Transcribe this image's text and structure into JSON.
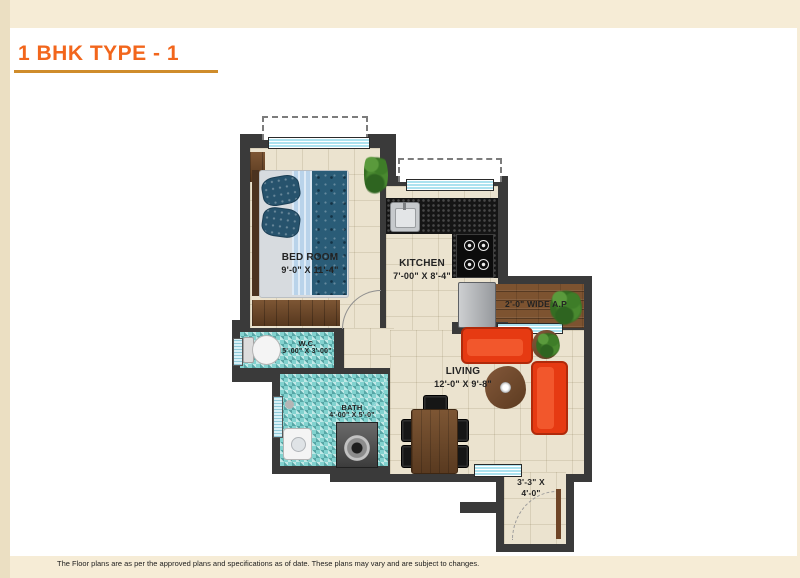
{
  "title": "1 BHK TYPE - 1",
  "disclaimer": "The Floor plans are as per the approved plans and specifications as of date. These plans may vary and are subject to changes.",
  "plan": {
    "bedroom": {
      "name": "BED ROOM",
      "dims": "9'-0\" X 11'-4\""
    },
    "kitchen": {
      "name": "KITCHEN",
      "dims": "7'-00\" X 8'-4\""
    },
    "wc": {
      "name": "W.C.",
      "dims": "5'-00\" X 3'-00\""
    },
    "bath": {
      "name": "BATH",
      "dims": "4'-00\" X 5'-0\""
    },
    "living": {
      "name": "LIVING",
      "dims": "12'-0\" X 9'-8\""
    },
    "air_passage": {
      "name": "2'-0\" WIDE A.P"
    },
    "entrance": {
      "line1": "3'-3\" X",
      "line2": "4'-0\""
    }
  },
  "colors": {
    "background": "#f6ecd6",
    "left_strip": "#ebdfc2",
    "panel": "#ffffff",
    "title_orange": "#f2661c",
    "underline_gold": "#cf8c2b",
    "wall": "#3a3a3a",
    "floor_cream": "#ebe3cf",
    "mosaic_teal": "#82d2cf",
    "window_blue": "#ace2ef",
    "sofa_red": "#e63a12",
    "wood_brown": "#7d5330"
  }
}
